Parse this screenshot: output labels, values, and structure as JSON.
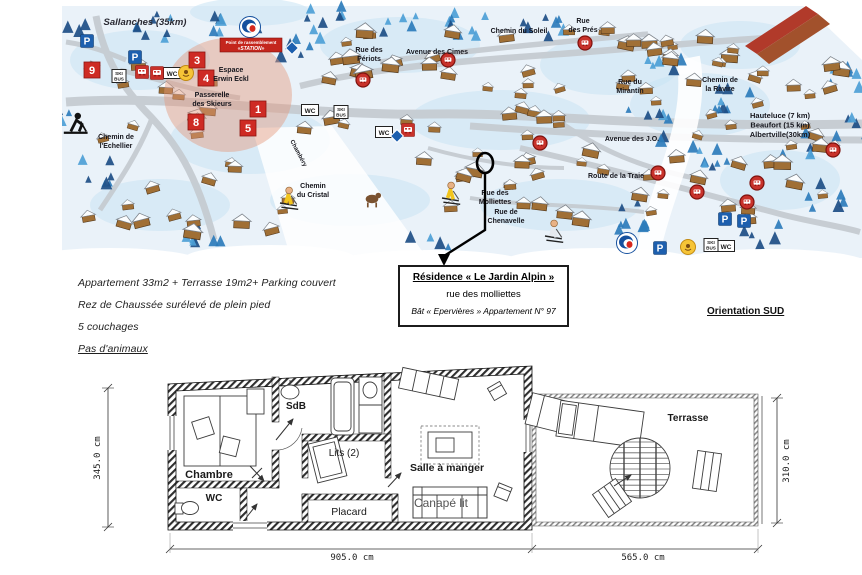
{
  "map": {
    "banner": {
      "x": 251,
      "y": 45,
      "lines": [
        "Point de rassemblement",
        "«STATION»"
      ]
    },
    "labels": [
      {
        "lines": [
          "Sallanches (35km)"
        ],
        "x": 145,
        "y": 25,
        "size": 9.5,
        "w": 700,
        "i": true,
        "c": "#2a2a33"
      },
      {
        "lines": [
          "Rue des",
          "Périots"
        ],
        "x": 369,
        "y": 52,
        "size": 7
      },
      {
        "lines": [
          "Avenue des Cimes"
        ],
        "x": 437,
        "y": 54,
        "size": 7
      },
      {
        "lines": [
          "Chemin du Soleil"
        ],
        "x": 519,
        "y": 33,
        "size": 7
      },
      {
        "lines": [
          "Rue",
          "des Prés"
        ],
        "x": 583,
        "y": 23,
        "size": 7
      },
      {
        "lines": [
          "Rue du",
          "Mirantin"
        ],
        "x": 630,
        "y": 84,
        "size": 7
      },
      {
        "lines": [
          "Chemin de",
          "la Ravire"
        ],
        "x": 720,
        "y": 82,
        "size": 7
      },
      {
        "lines": [
          "Avenue des J.O."
        ],
        "x": 632,
        "y": 141,
        "size": 7
      },
      {
        "lines": [
          "Route de la Traie"
        ],
        "x": 616,
        "y": 178,
        "size": 7
      },
      {
        "lines": [
          "Rue des",
          "Molliettes"
        ],
        "x": 495,
        "y": 195,
        "size": 7
      },
      {
        "lines": [
          "Rue de",
          "Chenavelle"
        ],
        "x": 506,
        "y": 214,
        "size": 7
      },
      {
        "lines": [
          "Chemin",
          "du Cristal"
        ],
        "x": 313,
        "y": 188,
        "size": 7
      },
      {
        "lines": [
          "Chemin de",
          "l'Echellier"
        ],
        "x": 116,
        "y": 139,
        "size": 7
      },
      {
        "lines": [
          "Espace",
          "Erwin Eckl"
        ],
        "x": 231,
        "y": 72,
        "size": 7
      },
      {
        "lines": [
          "Passerelle",
          "des Skieurs"
        ],
        "x": 212,
        "y": 97,
        "size": 7
      },
      {
        "lines": [
          "Chambéry"
        ],
        "x": 297,
        "y": 154,
        "size": 6,
        "r": 62
      },
      {
        "lines": [
          "Hauteluce (7 km)",
          "Beaufort (15 km)",
          "Albertville(30km)"
        ],
        "x": 780,
        "y": 118,
        "size": 7.5,
        "w": 700
      }
    ],
    "markers": [
      {
        "n": "9",
        "x": 92,
        "y": 70
      },
      {
        "n": "3",
        "x": 197,
        "y": 60
      },
      {
        "n": "4",
        "x": 206,
        "y": 78
      },
      {
        "n": "1",
        "x": 258,
        "y": 109
      },
      {
        "n": "5",
        "x": 248,
        "y": 128
      },
      {
        "n": "8",
        "x": 196,
        "y": 122
      }
    ],
    "signs": [
      {
        "t": "p",
        "label": "P",
        "x": 87,
        "y": 41
      },
      {
        "t": "p",
        "label": "P",
        "x": 135,
        "y": 57
      },
      {
        "t": "p",
        "label": "P",
        "x": 725,
        "y": 219
      },
      {
        "t": "p",
        "label": "P",
        "x": 744,
        "y": 221
      },
      {
        "t": "p",
        "label": "P",
        "x": 660,
        "y": 248
      },
      {
        "t": "wc",
        "label": "WC",
        "x": 172,
        "y": 73
      },
      {
        "t": "wc",
        "label": "WC",
        "x": 310,
        "y": 110
      },
      {
        "t": "wc",
        "label": "WC",
        "x": 384,
        "y": 132
      },
      {
        "t": "wc",
        "label": "WC",
        "x": 726,
        "y": 246
      },
      {
        "t": "skibus",
        "label": "SKI BUS",
        "x": 119,
        "y": 76
      },
      {
        "t": "skibus",
        "label": "SKI BUS",
        "x": 341,
        "y": 112
      },
      {
        "t": "skibus",
        "label": "SKI BUS",
        "x": 711,
        "y": 245
      },
      {
        "t": "bus",
        "label": "",
        "x": 142,
        "y": 72
      },
      {
        "t": "bus",
        "label": "",
        "x": 157,
        "y": 73
      },
      {
        "t": "bus",
        "label": "",
        "x": 408,
        "y": 130
      },
      {
        "t": "busc",
        "label": "",
        "x": 363,
        "y": 80
      },
      {
        "t": "busc",
        "label": "",
        "x": 448,
        "y": 60
      },
      {
        "t": "busc",
        "label": "",
        "x": 585,
        "y": 43
      },
      {
        "t": "busc",
        "label": "",
        "x": 540,
        "y": 143
      },
      {
        "t": "busc",
        "label": "",
        "x": 658,
        "y": 173
      },
      {
        "t": "busc",
        "label": "",
        "x": 697,
        "y": 192
      },
      {
        "t": "busc",
        "label": "",
        "x": 757,
        "y": 183
      },
      {
        "t": "busc",
        "label": "",
        "x": 747,
        "y": 202
      },
      {
        "t": "busc",
        "label": "",
        "x": 833,
        "y": 150
      },
      {
        "t": "logo",
        "label": "",
        "x": 250,
        "y": 27
      },
      {
        "t": "logo",
        "label": "",
        "x": 627,
        "y": 243
      },
      {
        "t": "diamond",
        "label": "",
        "x": 397,
        "y": 136
      },
      {
        "t": "diamond",
        "label": "",
        "x": 292,
        "y": 48
      },
      {
        "t": "sun",
        "label": "",
        "x": 186,
        "y": 73
      },
      {
        "t": "sun",
        "label": "",
        "x": 688,
        "y": 247
      }
    ],
    "figures": [
      {
        "k": "picto",
        "x": 75,
        "y": 123
      },
      {
        "k": "skier",
        "x": 287,
        "y": 196,
        "c": "#f2c51d"
      },
      {
        "k": "skier",
        "x": 449,
        "y": 191,
        "c": "#f2c51d"
      },
      {
        "k": "skier",
        "x": 552,
        "y": 229,
        "c": "#e5e9ee"
      },
      {
        "k": "animal",
        "x": 372,
        "y": 199,
        "c": "#7a5230"
      }
    ]
  },
  "notes": {
    "lines": [
      {
        "text": "Appartement 33m2 + Terrasse 19m2+ Parking couvert",
        "underline": false
      },
      {
        "text": "Rez de Chaussée surélevé de plein pied",
        "underline": false
      },
      {
        "text": "5 couchages",
        "underline": false
      },
      {
        "text": "Pas d'animaux",
        "underline": true
      }
    ]
  },
  "address_box": {
    "title": "Résidence « Le Jardin Alpin »",
    "street": "rue des molliettes",
    "building": "Bât « Epervières »  Appartement N° 97"
  },
  "orientation": "Orientation SUD",
  "floorplan": {
    "room_labels": [
      {
        "text": "Chambre",
        "x": 209,
        "y": 478,
        "size": 11,
        "bold": true
      },
      {
        "text": "WC",
        "x": 214,
        "y": 501,
        "size": 10,
        "bold": true
      },
      {
        "text": "SdB",
        "x": 296,
        "y": 409,
        "size": 10,
        "bold": true
      },
      {
        "text": "Lits (2)",
        "x": 344,
        "y": 456,
        "size": 10
      },
      {
        "text": "Placard",
        "x": 349,
        "y": 515,
        "size": 10.5
      },
      {
        "text": "Salle à manger",
        "x": 447,
        "y": 471,
        "size": 10.5,
        "bold": true
      },
      {
        "text": "Canapé lit",
        "x": 441,
        "y": 507,
        "size": 12,
        "color": "#555"
      },
      {
        "text": "Terrasse",
        "x": 688,
        "y": 421,
        "size": 10,
        "bold": true
      }
    ],
    "dimensions": [
      {
        "text": "345.0 cm",
        "x": 100,
        "y": 458,
        "rot": -90
      },
      {
        "text": "310.0 cm",
        "x": 789,
        "y": 461,
        "rot": -90
      },
      {
        "text": "905.0 cm",
        "x": 352,
        "y": 560,
        "rot": 0
      },
      {
        "text": "565.0 cm",
        "x": 643,
        "y": 560,
        "rot": 0
      }
    ]
  }
}
